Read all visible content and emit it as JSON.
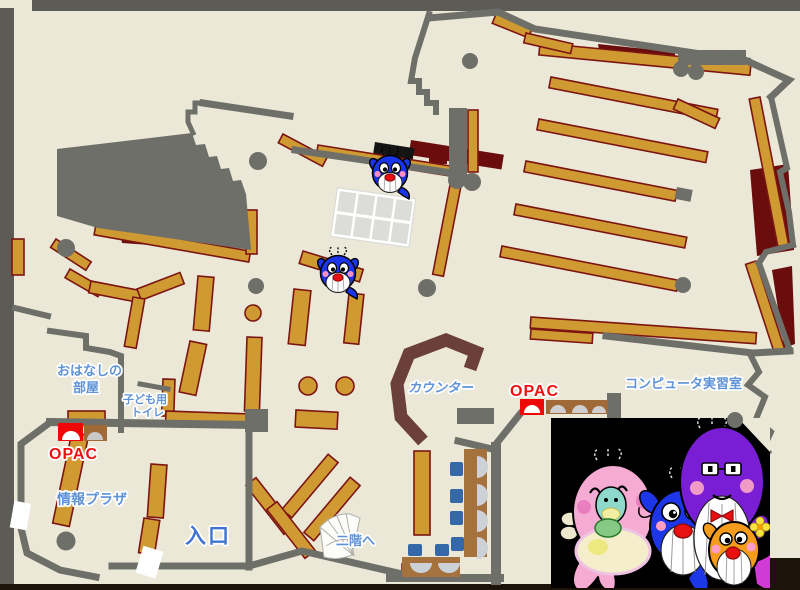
{
  "title": "library-first-floor-map",
  "labels": {
    "story_room_1": "おはなしの",
    "story_room_2": "部屋",
    "kids_toilet_1": "子ども用",
    "kids_toilet_2": "トイレ",
    "opac_left": "OPAC",
    "opac_center": "OPAC",
    "info_plaza": "情報プラザ",
    "entrance": "入口",
    "stairs": "二階へ",
    "counter": "カウンター",
    "computer_room": "コンピュータ実習室"
  },
  "colors": {
    "floor": "#ebe8d8",
    "wall_gray": "#6f6f69",
    "frame_gray": "#5c5b55",
    "frame_dark": "#1c1309",
    "shelf_fill": "#d09a33",
    "shelf_border": "#7c1511",
    "accent_dark_red": "#6b0d0d",
    "counter_brown": "#6a3f3c",
    "table_brown": "#a5713c",
    "label_blue": "#5f93d8",
    "entrance_blue": "#3f74d4",
    "opac_red": "#ee1111",
    "machine_red": "#ee0808",
    "machine_brown": "#a06a38",
    "chair_blue": "#3568a8",
    "seat_gray": "#ccd1d8",
    "photo_bg": "#000000"
  },
  "icons": {
    "map_mascots": [
      "blue-whale-mascot",
      "blue-whale-mascot"
    ],
    "photo_mascots": [
      "pink-whale-mascot",
      "teal-baby-whale-mascot",
      "blue-whale-mascot",
      "purple-whale-mascot",
      "orange-whale-mascot"
    ]
  }
}
